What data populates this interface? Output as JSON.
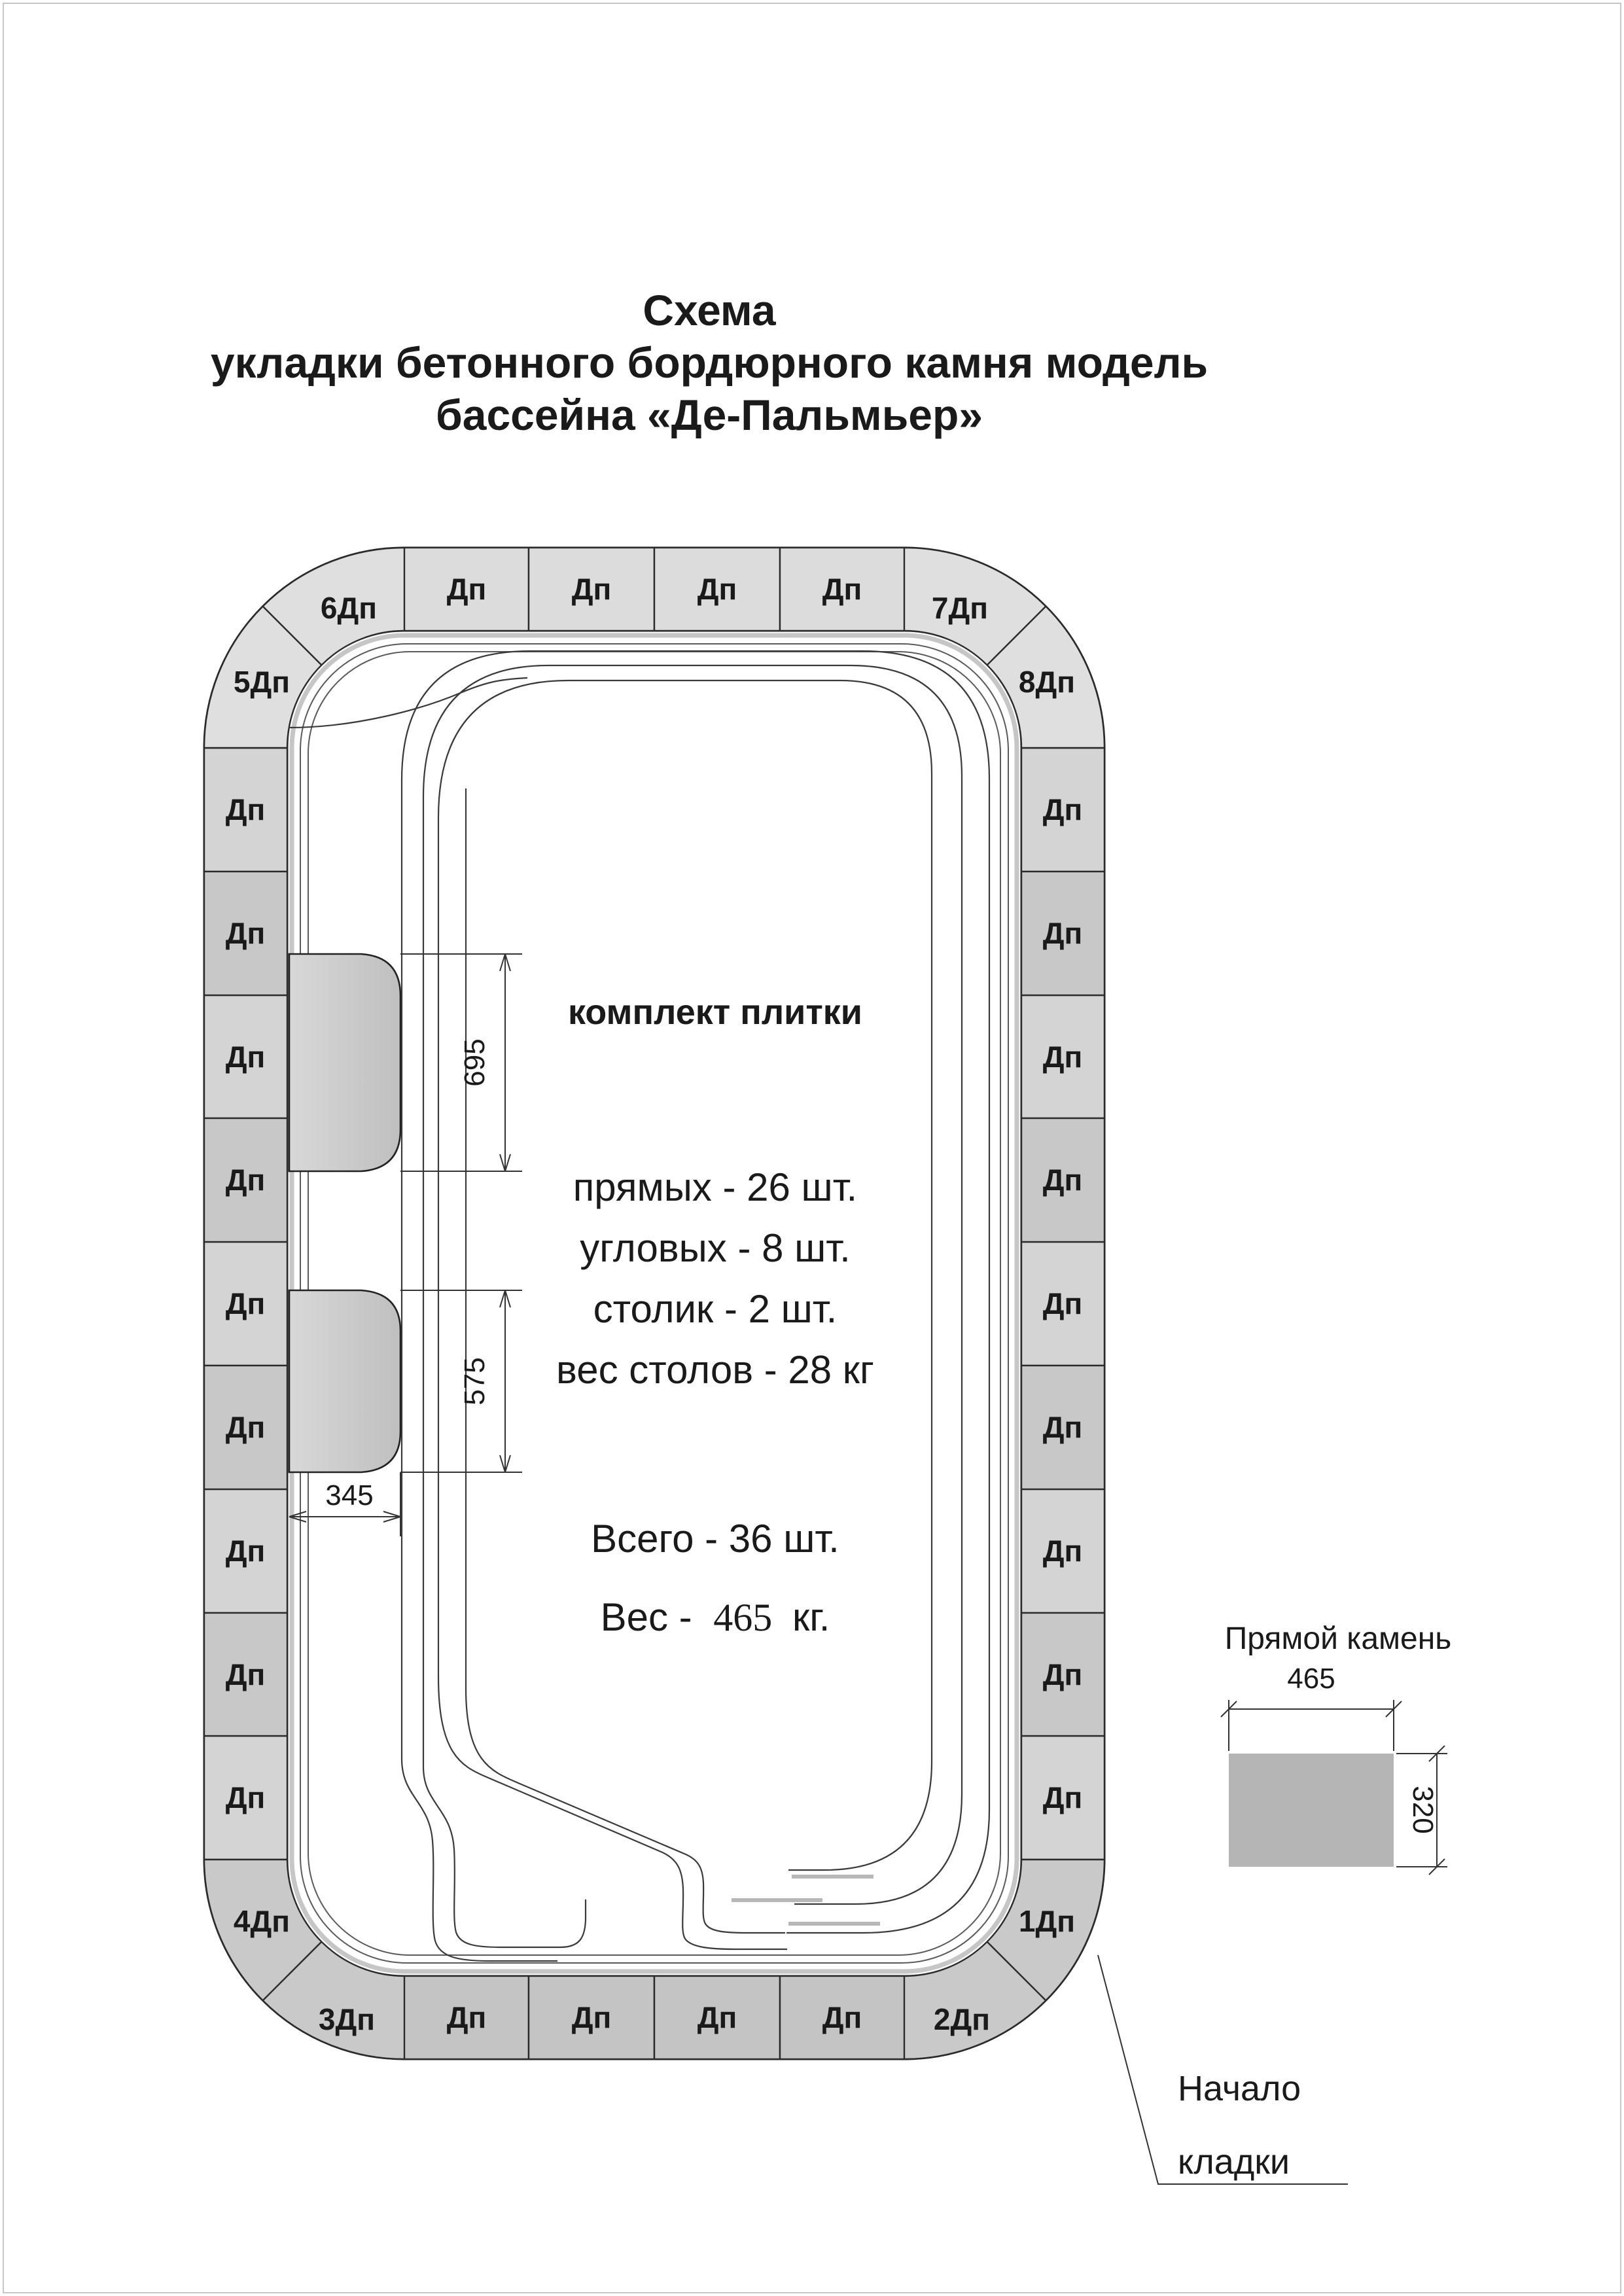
{
  "title": {
    "line1": "Схема",
    "line2": "укладки бетонного бордюрного камня модель",
    "line3": "бассейна «Де-Пальмьер»"
  },
  "tiles": {
    "straight_label": "Дп",
    "corners": [
      "1Дп",
      "2Дп",
      "3Дп",
      "4Дп",
      "5Дп",
      "6Дп",
      "7Дп",
      "8Дп"
    ],
    "straight_count_top": 4,
    "straight_count_bottom": 4,
    "straight_count_left": 9,
    "straight_count_right": 9
  },
  "dimensions": {
    "table_zone_1": "695",
    "table_zone_2": "575",
    "table_depth": "345"
  },
  "info": {
    "heading": "комплект плитки",
    "line_straight": "прямых - 26 шт.",
    "line_corner": "угловых - 8 шт.",
    "line_table": "столик - 2 шт.",
    "line_table_weight": "вес столов - 28 кг",
    "total": "Всего - 36 шт.",
    "weight_prefix": "Вес -",
    "weight_value": "465",
    "weight_suffix": "кг."
  },
  "detail": {
    "title": "Прямой камень",
    "width": "465",
    "height": "320"
  },
  "annotation": {
    "line1": "Начало",
    "line2": "кладки"
  },
  "colors": {
    "ring_base": "#d0d0d0",
    "tile_top": "#dcdcdc",
    "tile_bottom": "#c4c4c4",
    "tile_side_a": "#d4d4d4",
    "tile_side_b": "#c8c8c8",
    "corner_top": "#dfdfdf",
    "corner_bottom": "#c9c9c9",
    "stone_fill": "#b5b5b5",
    "table_from": "#d8d8d8",
    "table_to": "#bfbfbf",
    "line": "#2b2b2b",
    "page_border": "#c6c6c6"
  }
}
